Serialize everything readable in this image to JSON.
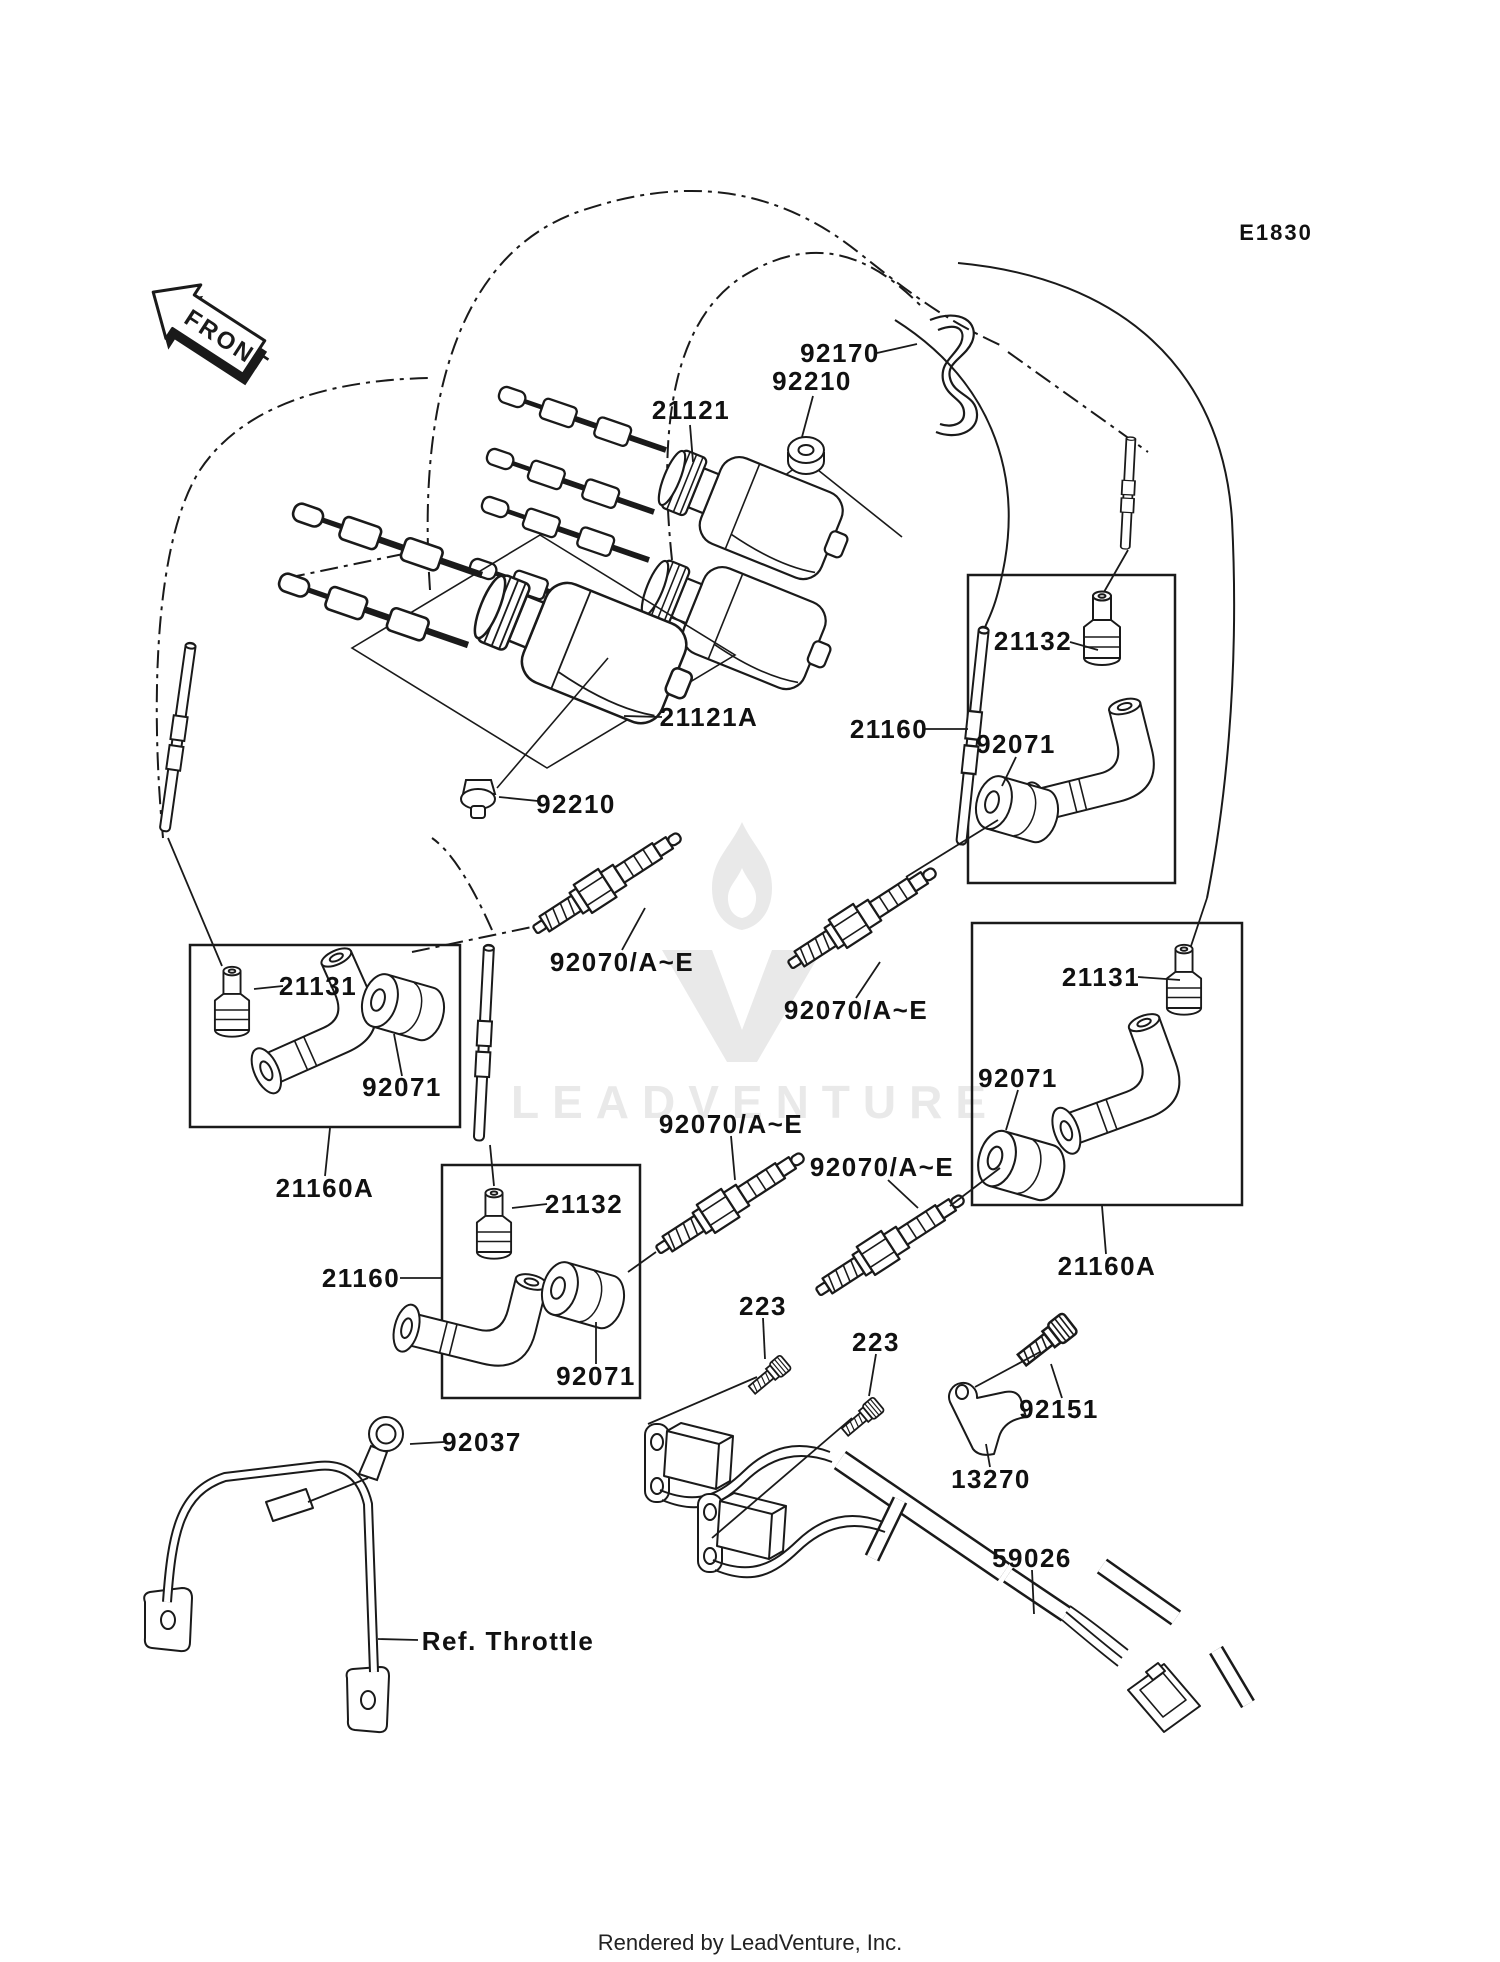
{
  "diagram": {
    "drawing_code": "E1830",
    "front_marker": "FRONT",
    "watermark": {
      "text": "LEADVENTURE",
      "color": "#e9e9e9"
    },
    "footer": {
      "text": "Rendered by LeadVenture, Inc."
    },
    "line_color": "#1a1a1a",
    "part_labels": {
      "p92170": "92170",
      "p92210_top": "92210",
      "p21121": "21121",
      "p21132_right": "21132",
      "p21160_right": "21160",
      "p92071_right_top": "92071",
      "p21121a": "21121A",
      "p92210_lower": "92210",
      "p92070_1": "92070/A~E",
      "p21131_left": "21131",
      "p92071_left": "92071",
      "p21160a_left": "21160A",
      "p21131_right": "21131",
      "p92070_2": "92070/A~E",
      "p92070_3": "92070/A~E",
      "p92070_4": "92070/A~E",
      "p92071_right_bottom": "92071",
      "p21160a_right": "21160A",
      "p21132_mid": "21132",
      "p21160_mid": "21160",
      "p92071_mid": "92071",
      "p223_1": "223",
      "p223_2": "223",
      "p92151": "92151",
      "p13270": "13270",
      "p59026": "59026",
      "p92037": "92037",
      "ref_throttle": "Ref. Throttle"
    }
  }
}
